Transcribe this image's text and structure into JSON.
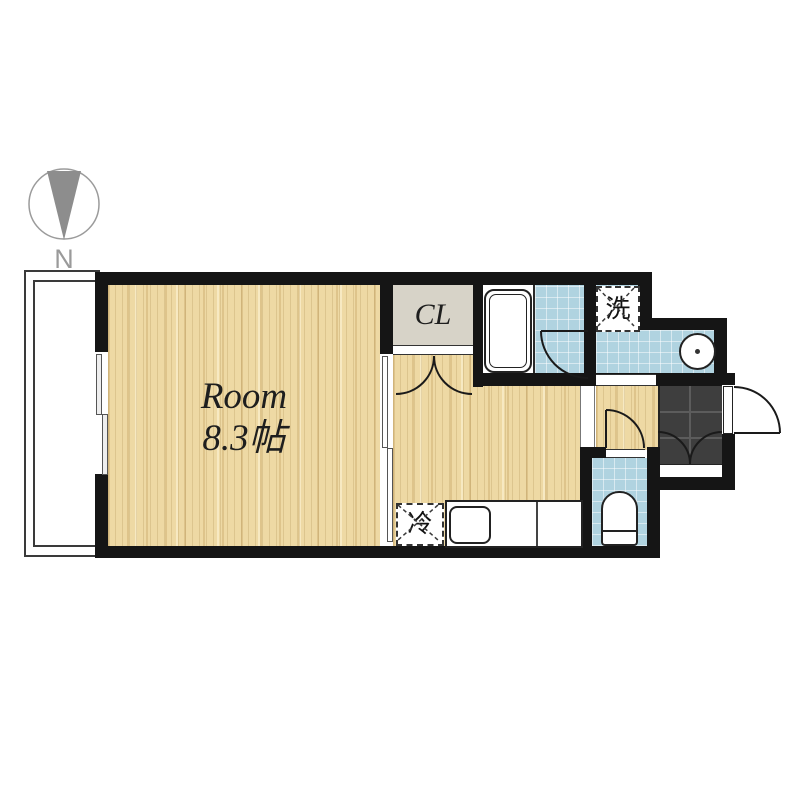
{
  "compass": {
    "label": "N"
  },
  "rooms": {
    "main": {
      "label": "Room",
      "size": "8.3帖"
    },
    "closet": {
      "label": "CL"
    },
    "laundry": {
      "label": "洗"
    },
    "refrigerator": {
      "label": "冷"
    }
  },
  "colors": {
    "wall": "#151515",
    "wood_floor": "#eed9a4",
    "wet_area_tile": "#b0d3e0",
    "closet_floor": "#d7d3c8",
    "entrance_tile": "#3e3e3e"
  }
}
